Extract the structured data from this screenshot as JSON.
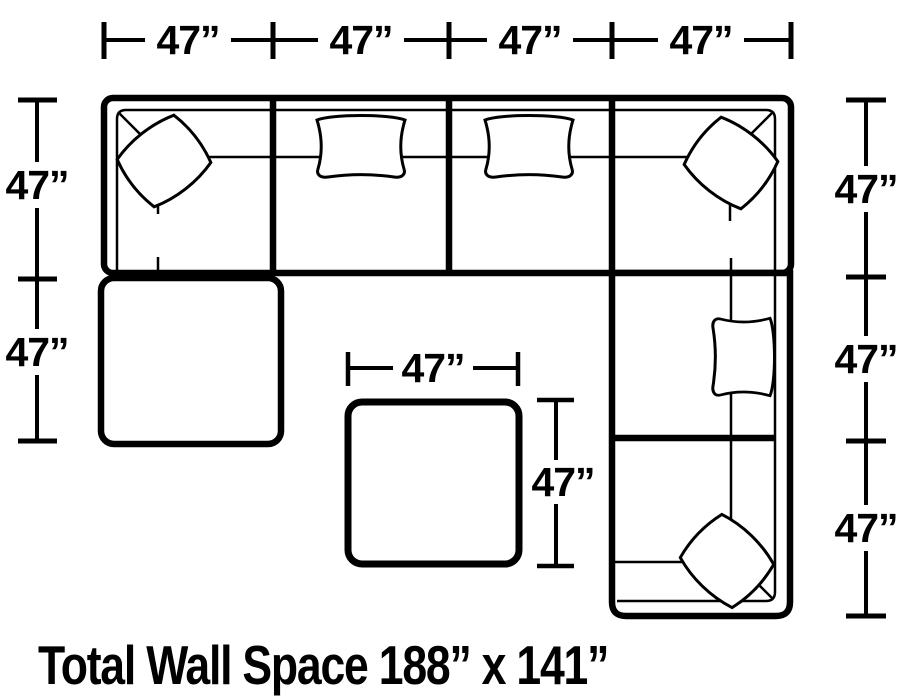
{
  "footer": {
    "total_wall_space": "Total Wall Space 188” x 141”"
  },
  "dimensions": {
    "top": [
      "47”",
      "47”",
      "47”",
      "47”"
    ],
    "left": [
      "47”",
      "47”"
    ],
    "right": [
      "47”",
      "47”",
      "47”"
    ],
    "ottoman": {
      "width": "47”",
      "height": "47”"
    }
  },
  "colors": {
    "line": "#000000",
    "background": "#ffffff"
  }
}
